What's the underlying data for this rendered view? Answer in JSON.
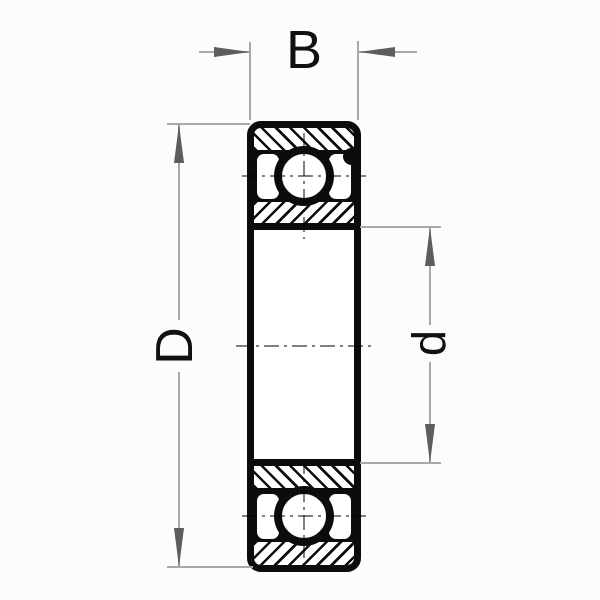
{
  "drawing": {
    "title": "bearing-cross-section",
    "labels": {
      "width": "B",
      "outer_diameter": "D",
      "bore_diameter": "d"
    },
    "colors": {
      "line": "#0c0c0c",
      "dimension_line": "#a8a8a8",
      "arrow": "#5d5d5d",
      "centerline": "#818181",
      "text": "#111111",
      "background": "#fcfcfc"
    }
  }
}
